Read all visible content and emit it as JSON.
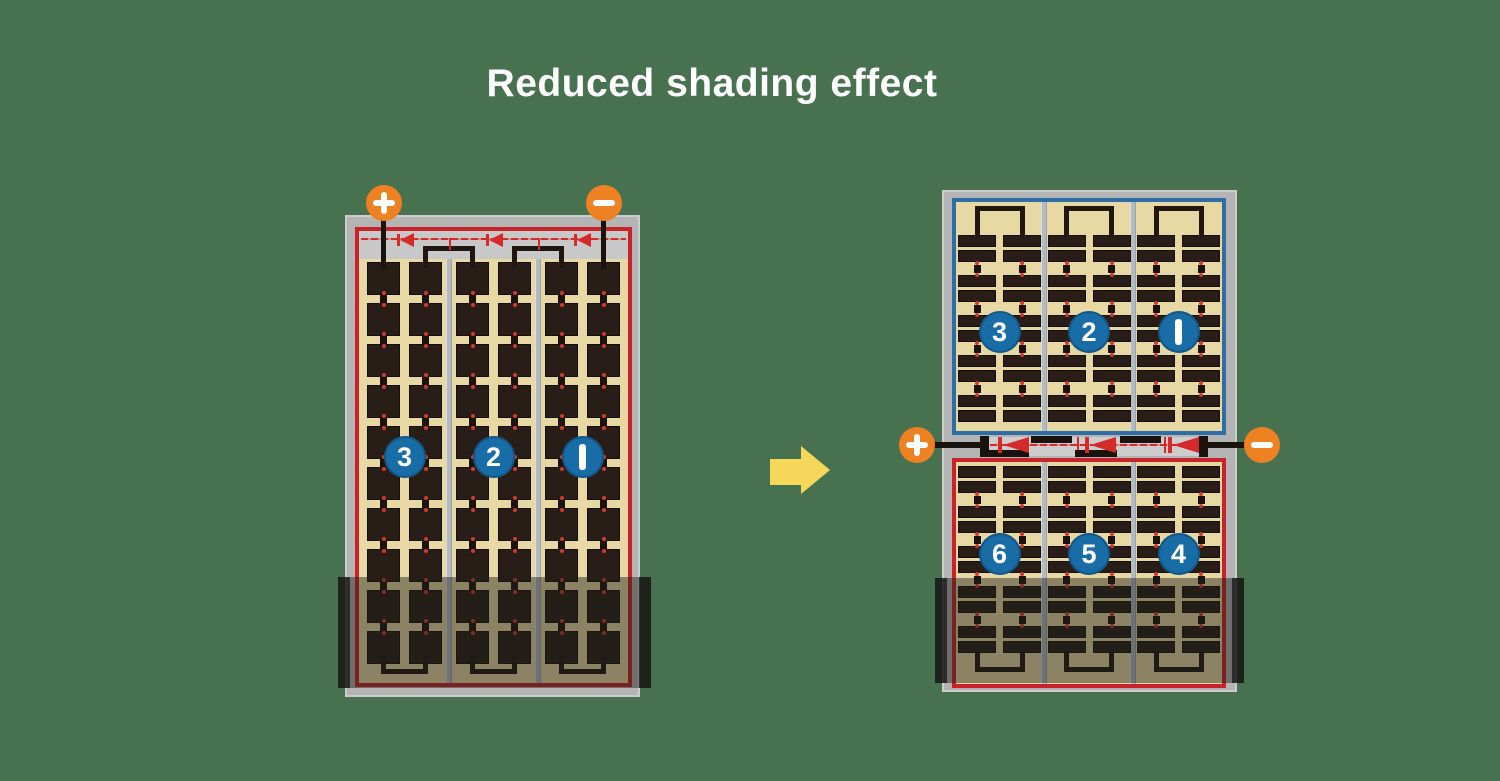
{
  "title": "Reduced shading effect",
  "left_panel": {
    "terminal_plus": "+",
    "terminal_minus": "−",
    "section_labels": [
      "3",
      "2",
      "1"
    ]
  },
  "right_panel": {
    "terminal_plus": "+",
    "terminal_minus": "−",
    "top_section_labels": [
      "3",
      "2",
      "1"
    ],
    "bottom_section_labels": [
      "6",
      "5",
      "4"
    ]
  },
  "icons": {
    "arrow": "right-arrow",
    "diode": "left-pointing-diode",
    "plus": "plus-icon",
    "minus": "minus-icon"
  },
  "colors": {
    "background": "#48714f",
    "title_text": "#ffffff",
    "panel_frame": "#b4b4b4",
    "panel_frame_edge": "#cdcdcd",
    "panel_top_strip": "#c8c8c8",
    "junction_strip": "#cdcdcd",
    "cell_background": "#e8d8a4",
    "cell": "#281e17",
    "cell_outline": "#151009",
    "busbar": "#20170f",
    "wire_black": "#1a120c",
    "divider": "#b2bac2",
    "divider_light": "#d8dde2",
    "divider_dark": "#9aa2ab",
    "series_border_red": "#c8232a",
    "series_border_blue": "#2e6ea7",
    "diode_red": "#d42a2a",
    "diode_dash": "rgba(212,42,42,0.35)",
    "circle_blue": "#186da6",
    "circle_ring": "rgba(8,45,80,0.35)",
    "terminal_orange": "#ee8122",
    "terminal_glyph": "#ffffff",
    "arrow_yellow": "#f6d75a",
    "shade": "rgba(33,30,27,0.46)",
    "shade_cap": "rgba(20,18,17,0.72)",
    "tab_black": "#1c130e",
    "tab_dot_red": "#cf3b30"
  }
}
